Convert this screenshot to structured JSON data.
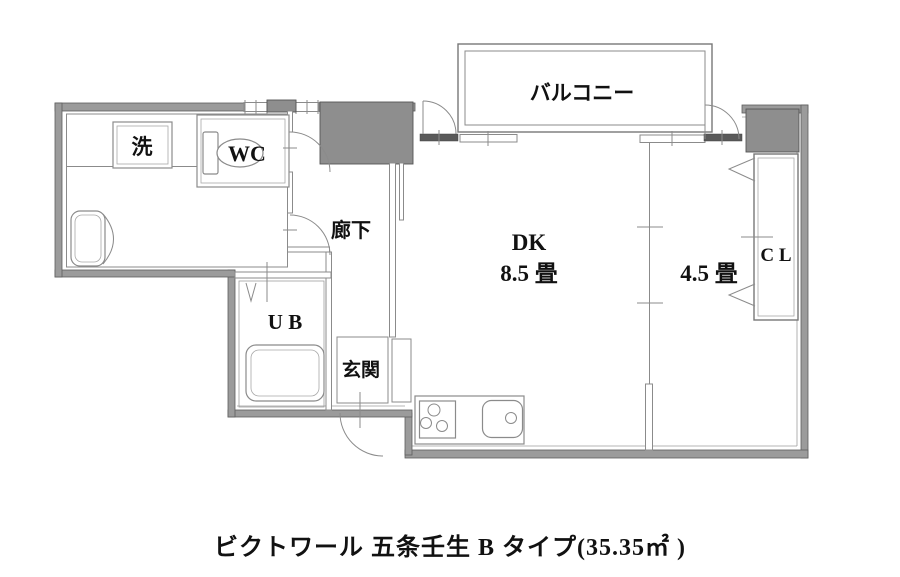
{
  "caption": "ビクトワール 五条壬生 B タイプ(35.35㎡ )",
  "labels": {
    "balcony": "バルコニー",
    "dk": "DK",
    "dk_size": "8.5 畳",
    "room45": "4.5 畳",
    "closet": "C L",
    "hallway": "廊下",
    "wc": "WC",
    "laundry": "洗",
    "unit_bath": "U B",
    "entrance": "玄関"
  },
  "colors": {
    "wall": "#9b9b9b",
    "structural_block": "#8e8e8e",
    "line": "#8b8b8b",
    "threshold_dark": "#5a5a5a",
    "text": "#111111",
    "background": "#ffffff"
  }
}
